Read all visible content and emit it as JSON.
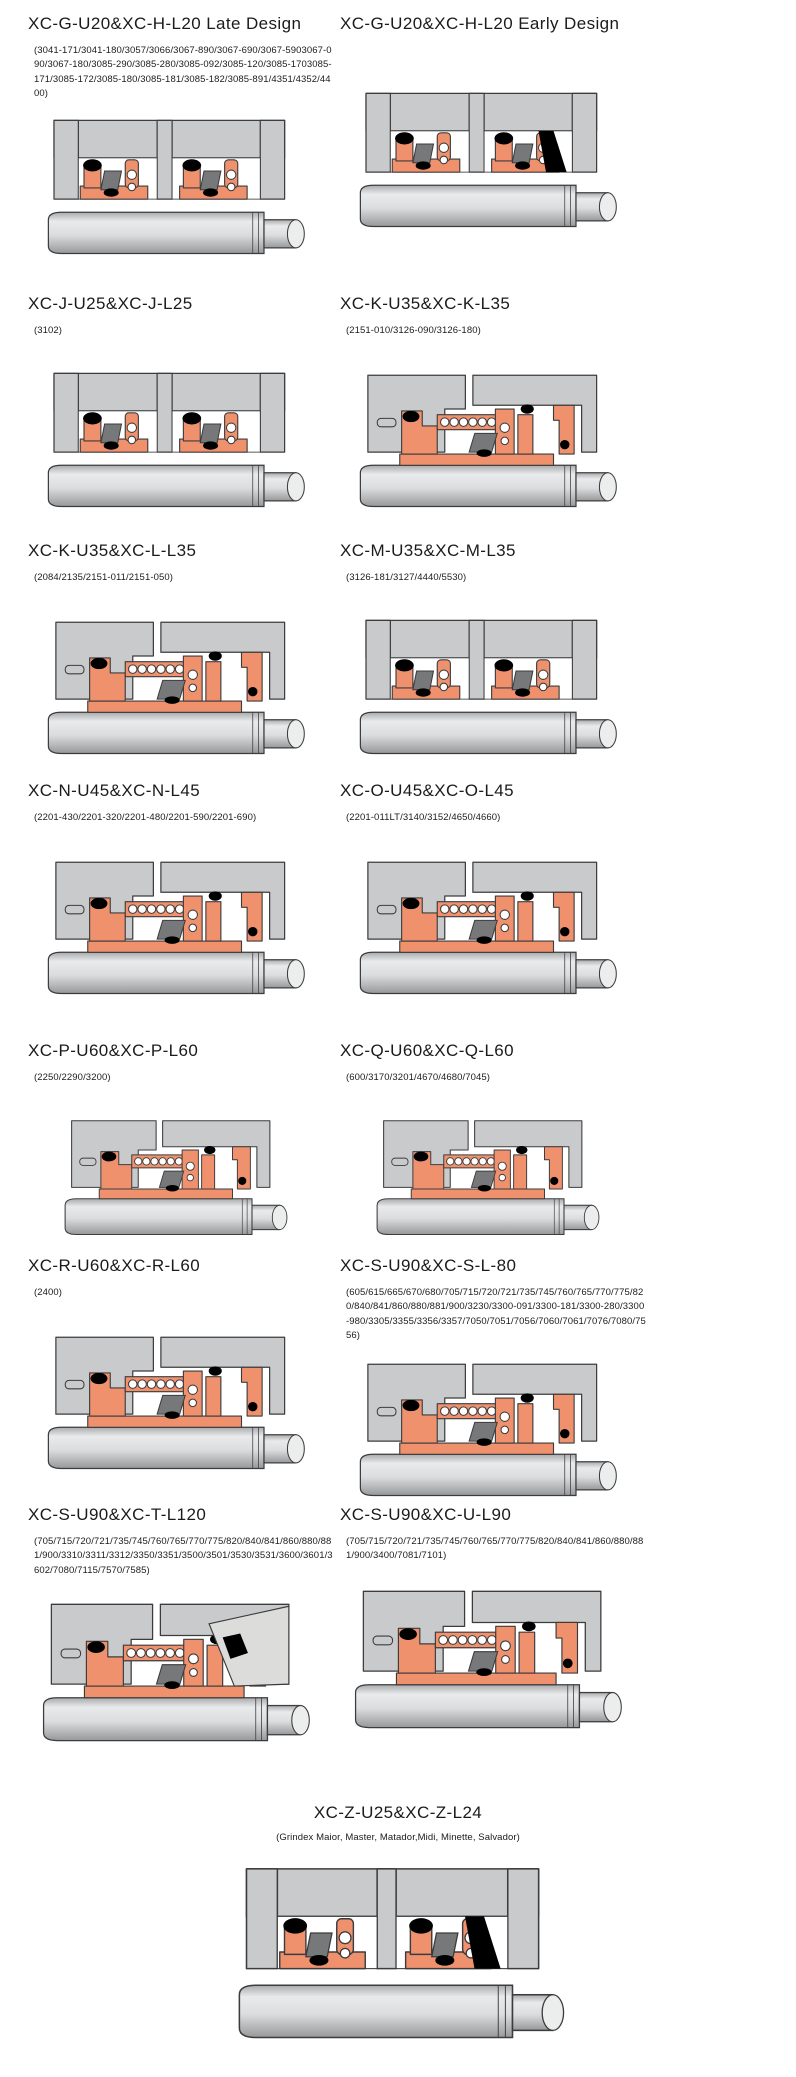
{
  "page": {
    "background": "#ffffff"
  },
  "colors": {
    "housing": "#c9cacc",
    "part": "#f0916e",
    "outline": "#3c3c3e",
    "metal": "#77787a",
    "black": "#000000",
    "shaft_light": "#eceded",
    "shaft_mid": "#dcdddf",
    "shaft_dark": "#97989a",
    "wedge": "#dcdcda"
  },
  "entries": [
    {
      "title": "XC-G-U20&XC-H-L20 Late Design",
      "subtitle": "(3041-171/3041-180/3057/3066/3067-890/3067-690/3067-5903067-090/3067-180/3085-290/3085-280/3085-092/3085-120/3085-1703085-171/3085-172/3085-180/3085-181/3085-182/3085-891/4351/4352/4400)"
    },
    {
      "title": "XC-G-U20&XC-H-L20 Early Design",
      "subtitle": ""
    },
    {
      "title": "XC-J-U25&XC-J-L25",
      "subtitle": "(3102)"
    },
    {
      "title": "XC-K-U35&XC-K-L35",
      "subtitle": "(2151-010/3126-090/3126-180)"
    },
    {
      "title": "XC-K-U35&XC-L-L35",
      "subtitle": "(2084/2135/2151-011/2151-050)"
    },
    {
      "title": "XC-M-U35&XC-M-L35",
      "subtitle": "(3126-181/3127/4440/5530)"
    },
    {
      "title": "XC-N-U45&XC-N-L45",
      "subtitle": "(2201-430/2201-320/2201-480/2201-590/2201-690)"
    },
    {
      "title": "XC-O-U45&XC-O-L45",
      "subtitle": "(2201-011LT/3140/3152/4650/4660)"
    },
    {
      "title": "XC-P-U60&XC-P-L60",
      "subtitle": "(2250/2290/3200)"
    },
    {
      "title": "XC-Q-U60&XC-Q-L60",
      "subtitle": "(600/3170/3201/4670/4680/7045)"
    },
    {
      "title": "XC-R-U60&XC-R-L60",
      "subtitle": "(2400)"
    },
    {
      "title": "XC-S-U90&XC-S-L-80",
      "subtitle": "(605/615/665/670/680/705/715/720/721/735/745/760/765/770/775/820/840/841/860/880/881/900/3230/3300-091/3300-181/3300-280/3300-980/3305/3355/3356/3357/7050/7051/7056/7060/7061/7076/7080/7556)"
    },
    {
      "title": "XC-S-U90&XC-T-L120",
      "subtitle": "(705/715/720/721/735/745/760/765/770/775/820/840/841/860/880/881/900/3310/3311/3312/3350/3351/3500/3501/3530/3531/3600/3601/3602/7080/7115/7570/7585)"
    },
    {
      "title": "XC-S-U90&XC-U-L90",
      "subtitle": "(705/715/720/721/735/745/760/765/770/775/820/840/841/860/880/881/900/3400/7081/7101)"
    },
    {
      "title": "XC-Z-U25&XC-Z-L24",
      "subtitle": "(Grindex  Maior, Master, Matador,Midi, Minette, Salvador)"
    }
  ]
}
